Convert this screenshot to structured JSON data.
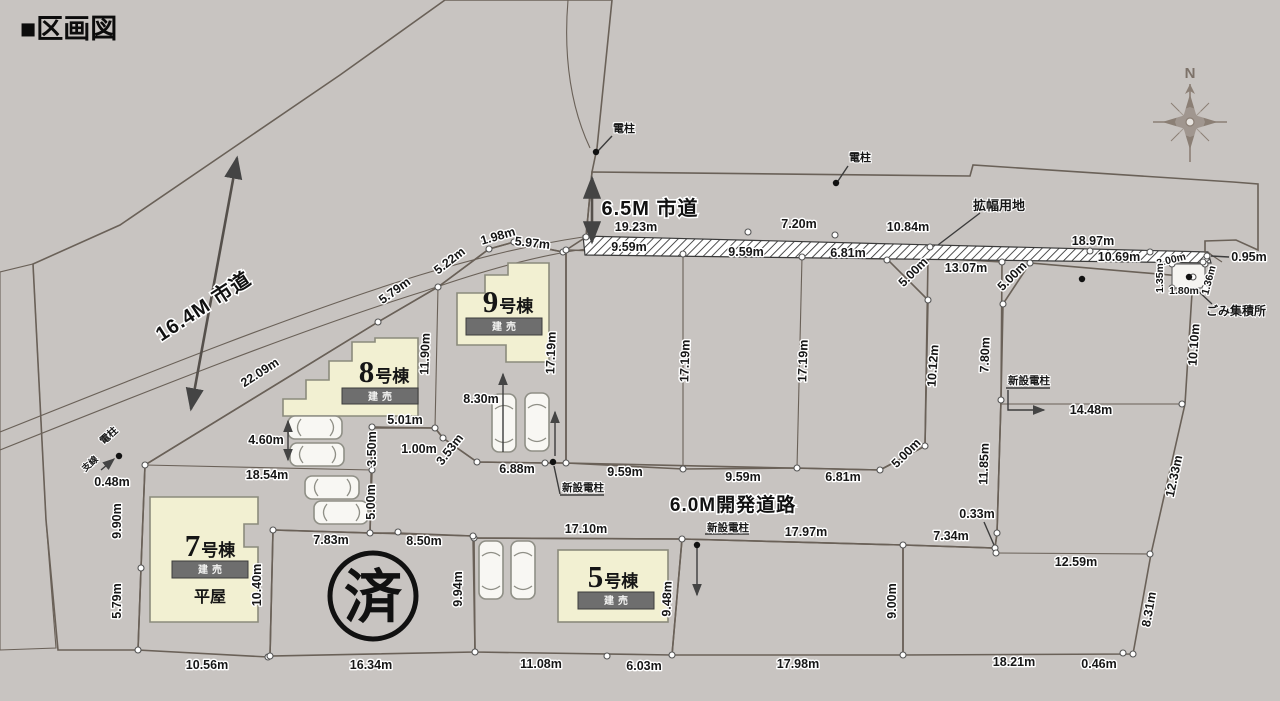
{
  "header": {
    "title": "■区画図"
  },
  "colors": {
    "background": "#c8c4c1",
    "road": "#e9e7e3",
    "road_inner": "#dbd8d3",
    "lot_sold_tan": "#d9a971",
    "lot_for_sale_yellow": "#ded793",
    "building": "#f2f0d2",
    "banner": "#6e6e6e"
  },
  "compass": {
    "north": "N"
  },
  "stamp": {
    "sold": "済"
  },
  "buildings": [
    {
      "num": "5",
      "suffix": "号棟",
      "banner": "建売"
    },
    {
      "num": "7",
      "suffix": "号棟",
      "banner": "建売",
      "note": "平屋"
    },
    {
      "num": "8",
      "suffix": "号棟",
      "banner": "建売"
    },
    {
      "num": "9",
      "suffix": "号棟",
      "banner": "建売"
    }
  ],
  "road_labels": [
    {
      "t": "6.5M 市道",
      "x": 650,
      "y": 215
    },
    {
      "t": "16.4M 市道",
      "x": 207,
      "y": 312,
      "r": -33
    },
    {
      "t": "6.0M開発道路",
      "x": 733,
      "y": 511,
      "s": 19
    }
  ],
  "annotation_labels": [
    {
      "t": "電柱",
      "x": 624,
      "y": 132
    },
    {
      "t": "電柱",
      "x": 860,
      "y": 161
    },
    {
      "t": "電柱",
      "x": 111,
      "y": 438,
      "s": 10,
      "r": -42
    },
    {
      "t": "支線",
      "x": 92,
      "y": 466,
      "s": 9,
      "r": -42
    },
    {
      "t": "新設電柱",
      "x": 583,
      "y": 491,
      "s": 10.5
    },
    {
      "t": "新設電柱",
      "x": 728,
      "y": 531,
      "s": 10.5
    },
    {
      "t": "新設電柱",
      "x": 1029,
      "y": 384,
      "s": 10.5
    },
    {
      "t": "拡幅用地",
      "x": 999,
      "y": 210,
      "s": 13
    },
    {
      "t": "ごみ集積所",
      "x": 1236,
      "y": 315,
      "s": 12
    }
  ],
  "dimensions": [
    {
      "t": "19.23m",
      "x": 636,
      "y": 231
    },
    {
      "t": "7.20m",
      "x": 799,
      "y": 228
    },
    {
      "t": "10.84m",
      "x": 908,
      "y": 231
    },
    {
      "t": "18.97m",
      "x": 1093,
      "y": 245
    },
    {
      "t": "10.69m",
      "x": 1119,
      "y": 261
    },
    {
      "t": "13.07m",
      "x": 966,
      "y": 272
    },
    {
      "t": "2.00m",
      "x": 1172,
      "y": 263,
      "r": -14,
      "s": 10.5
    },
    {
      "t": "0.95m",
      "x": 1249,
      "y": 261
    },
    {
      "t": "9.59m",
      "x": 629,
      "y": 251
    },
    {
      "t": "9.59m",
      "x": 746,
      "y": 256
    },
    {
      "t": "6.81m",
      "x": 848,
      "y": 257
    },
    {
      "t": "1.98m",
      "x": 499,
      "y": 240,
      "r": -16
    },
    {
      "t": "5.97m",
      "x": 532,
      "y": 247,
      "r": 6
    },
    {
      "t": "5.22m",
      "x": 452,
      "y": 264,
      "r": -38
    },
    {
      "t": "5.79m",
      "x": 397,
      "y": 294,
      "r": -36
    },
    {
      "t": "22.09m",
      "x": 262,
      "y": 376,
      "r": -33
    },
    {
      "t": "11.90m",
      "x": 429,
      "y": 354,
      "r": -88
    },
    {
      "t": "17.19m",
      "x": 555,
      "y": 353,
      "r": -88
    },
    {
      "t": "17.19m",
      "x": 689,
      "y": 361,
      "r": -88
    },
    {
      "t": "17.19m",
      "x": 807,
      "y": 361,
      "r": -88
    },
    {
      "t": "5.00m",
      "x": 916,
      "y": 275,
      "r": -45
    },
    {
      "t": "5.00m",
      "x": 1015,
      "y": 279,
      "r": -45
    },
    {
      "t": "10.12m",
      "x": 937,
      "y": 366,
      "r": -86
    },
    {
      "t": "10.10m",
      "x": 1198,
      "y": 345,
      "r": -86
    },
    {
      "t": "7.80m",
      "x": 989,
      "y": 355,
      "r": -88
    },
    {
      "t": "1.35m",
      "x": 1163,
      "y": 278,
      "r": -90,
      "s": 10.5
    },
    {
      "t": "1.36m",
      "x": 1212,
      "y": 281,
      "r": -75,
      "s": 10.5
    },
    {
      "t": "1.80m",
      "x": 1184,
      "y": 294,
      "s": 10.5
    },
    {
      "t": "14.48m",
      "x": 1091,
      "y": 414
    },
    {
      "t": "11.85m",
      "x": 988,
      "y": 464,
      "r": -88
    },
    {
      "t": "12.33m",
      "x": 1178,
      "y": 477,
      "r": -78
    },
    {
      "t": "5.00m",
      "x": 909,
      "y": 456,
      "r": -45
    },
    {
      "t": "9.59m",
      "x": 625,
      "y": 476
    },
    {
      "t": "9.59m",
      "x": 743,
      "y": 481
    },
    {
      "t": "6.81m",
      "x": 843,
      "y": 481
    },
    {
      "t": "8.30m",
      "x": 481,
      "y": 403
    },
    {
      "t": "6.88m",
      "x": 517,
      "y": 473
    },
    {
      "t": "5.01m",
      "x": 405,
      "y": 424
    },
    {
      "t": "1.00m",
      "x": 419,
      "y": 453
    },
    {
      "t": "3.53m",
      "x": 453,
      "y": 452,
      "r": -52
    },
    {
      "t": "3.50m",
      "x": 376,
      "y": 449,
      "r": -90
    },
    {
      "t": "5.00m",
      "x": 375,
      "y": 502,
      "r": -90
    },
    {
      "t": "4.60m",
      "x": 266,
      "y": 444
    },
    {
      "t": "18.54m",
      "x": 267,
      "y": 479
    },
    {
      "t": "0.48m",
      "x": 112,
      "y": 486
    },
    {
      "t": "9.90m",
      "x": 121,
      "y": 521,
      "r": -90
    },
    {
      "t": "5.79m",
      "x": 121,
      "y": 601,
      "r": -90
    },
    {
      "t": "10.56m",
      "x": 207,
      "y": 669
    },
    {
      "t": "16.34m",
      "x": 371,
      "y": 669
    },
    {
      "t": "7.83m",
      "x": 331,
      "y": 544
    },
    {
      "t": "8.50m",
      "x": 424,
      "y": 545
    },
    {
      "t": "10.40m",
      "x": 261,
      "y": 585,
      "r": -90
    },
    {
      "t": "9.94m",
      "x": 462,
      "y": 589,
      "r": -90
    },
    {
      "t": "17.10m",
      "x": 586,
      "y": 533
    },
    {
      "t": "11.08m",
      "x": 541,
      "y": 668
    },
    {
      "t": "6.03m",
      "x": 644,
      "y": 670
    },
    {
      "t": "9.48m",
      "x": 671,
      "y": 599,
      "r": -88
    },
    {
      "t": "17.97m",
      "x": 806,
      "y": 536
    },
    {
      "t": "17.98m",
      "x": 798,
      "y": 668
    },
    {
      "t": "9.00m",
      "x": 896,
      "y": 601,
      "r": -90
    },
    {
      "t": "7.34m",
      "x": 951,
      "y": 540
    },
    {
      "t": "0.33m",
      "x": 977,
      "y": 518
    },
    {
      "t": "12.59m",
      "x": 1076,
      "y": 566
    },
    {
      "t": "18.21m",
      "x": 1014,
      "y": 666
    },
    {
      "t": "0.46m",
      "x": 1099,
      "y": 668
    },
    {
      "t": "8.31m",
      "x": 1153,
      "y": 610,
      "r": -80
    }
  ]
}
